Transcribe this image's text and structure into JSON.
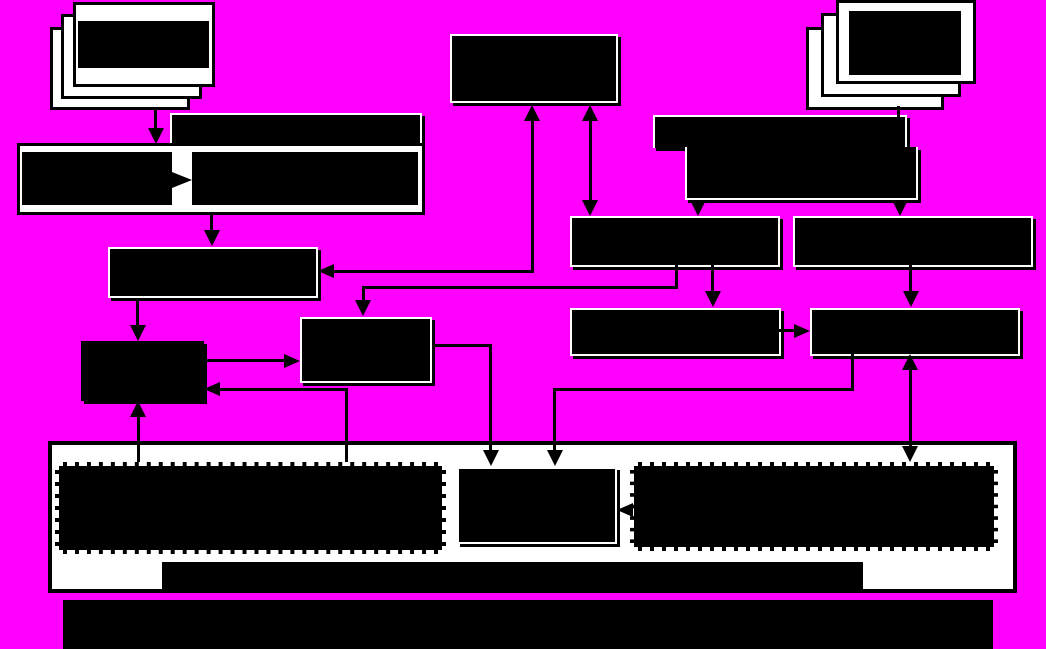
{
  "canvas": {
    "width": 1046,
    "height": 649
  },
  "colors": {
    "background": "#FF00FF",
    "node_fill": "#000000",
    "node_outline": "#FFFFFF",
    "container_fill": "#FFFFFF",
    "dashed_border": "#FFFFFF",
    "connector": "#000000"
  },
  "diagram": {
    "description": "Flowchart of solid black redacted blocks on a magenta background; no legible text is rendered in the image",
    "nodes": [
      {
        "id": "document-stack-left",
        "kind": "stacked-sheets",
        "sheets": 3,
        "bbox": [
          50,
          2,
          165,
          108
        ]
      },
      {
        "id": "document-stack-right",
        "kind": "stacked-sheets",
        "sheets": 3,
        "bbox": [
          806,
          0,
          168,
          110
        ]
      },
      {
        "id": "box-c",
        "kind": "black-box",
        "bbox": [
          450,
          34,
          168,
          69
        ]
      },
      {
        "id": "bar-a1",
        "kind": "black-bar",
        "bbox": [
          170,
          113,
          252,
          33
        ]
      },
      {
        "id": "box-a",
        "kind": "split-box-with-internal-arrow",
        "bbox": [
          17,
          143,
          408,
          72
        ]
      },
      {
        "id": "bar-b1",
        "kind": "black-bar",
        "bbox": [
          653,
          115,
          254,
          33
        ]
      },
      {
        "id": "bar-b2",
        "kind": "black-bar",
        "bbox": [
          685,
          147,
          233,
          53
        ]
      },
      {
        "id": "box-d",
        "kind": "black-box",
        "bbox": [
          108,
          247,
          210,
          51
        ]
      },
      {
        "id": "box-e",
        "kind": "black-box",
        "bbox": [
          300,
          317,
          132,
          66
        ]
      },
      {
        "id": "box-f",
        "kind": "black-box",
        "bbox": [
          81,
          341,
          123,
          60
        ]
      },
      {
        "id": "box-g1",
        "kind": "black-box",
        "bbox": [
          570,
          216,
          210,
          51
        ]
      },
      {
        "id": "box-g2",
        "kind": "black-box",
        "bbox": [
          793,
          216,
          240,
          51
        ]
      },
      {
        "id": "box-h1",
        "kind": "black-box",
        "bbox": [
          570,
          308,
          211,
          48
        ]
      },
      {
        "id": "box-h2",
        "kind": "black-box",
        "bbox": [
          810,
          308,
          210,
          48
        ]
      },
      {
        "id": "container",
        "kind": "white-container",
        "bbox": [
          48,
          441,
          969,
          152
        ]
      },
      {
        "id": "dashed-left",
        "kind": "dashed-black-box",
        "bbox": [
          55,
          462,
          391,
          92
        ]
      },
      {
        "id": "box-k",
        "kind": "black-box",
        "bbox": [
          457,
          467,
          160,
          77
        ]
      },
      {
        "id": "dashed-right",
        "kind": "dashed-black-box",
        "bbox": [
          630,
          462,
          368,
          89
        ]
      },
      {
        "id": "bar-j1",
        "kind": "black-bar",
        "bbox": [
          162,
          562,
          701,
          31
        ]
      },
      {
        "id": "bar-j2",
        "kind": "black-bar",
        "bbox": [
          63,
          600,
          930,
          49
        ]
      }
    ],
    "edges": [
      {
        "from": "document-stack-left",
        "to": "box-a",
        "style": "arrow-down"
      },
      {
        "from": "box-a.left-cell",
        "to": "box-a.right-cell",
        "style": "internal-arrow-right"
      },
      {
        "from": "box-a",
        "to": "box-d",
        "style": "arrow-down"
      },
      {
        "from": "box-c",
        "to": "box-d",
        "style": "bidirectional-elbow"
      },
      {
        "from": "box-c",
        "to": "box-g1",
        "style": "bidirectional-vertical"
      },
      {
        "from": "document-stack-right",
        "to": "bar-b1",
        "style": "plain-line"
      },
      {
        "from": "bar-b2",
        "to": "box-g1",
        "style": "arrow-down"
      },
      {
        "from": "bar-b2",
        "to": "box-g2",
        "style": "arrow-down"
      },
      {
        "from": "box-g1",
        "to": "box-e",
        "style": "elbow-arrow-down"
      },
      {
        "from": "box-g1",
        "to": "box-h1",
        "style": "arrow-down"
      },
      {
        "from": "box-g2",
        "to": "box-h2",
        "style": "arrow-down"
      },
      {
        "from": "box-h1",
        "to": "box-h2",
        "style": "arrow-right"
      },
      {
        "from": "box-d",
        "to": "box-f",
        "style": "arrow-down"
      },
      {
        "from": "box-f",
        "to": "box-e",
        "style": "arrow-right"
      },
      {
        "from": "dashed-left",
        "to": "box-f",
        "style": "arrow-up"
      },
      {
        "from": "dashed-left",
        "to": "box-f",
        "style": "elbow-arrow-left"
      },
      {
        "from": "box-e",
        "to": "box-k",
        "style": "elbow-arrow-down"
      },
      {
        "from": "box-h1",
        "to": "box-k",
        "style": "elbow-arrow-down"
      },
      {
        "from": "box-h2",
        "to": "dashed-right",
        "style": "bidirectional-vertical"
      },
      {
        "from": "dashed-right",
        "to": "box-k",
        "style": "arrow-left"
      }
    ]
  }
}
